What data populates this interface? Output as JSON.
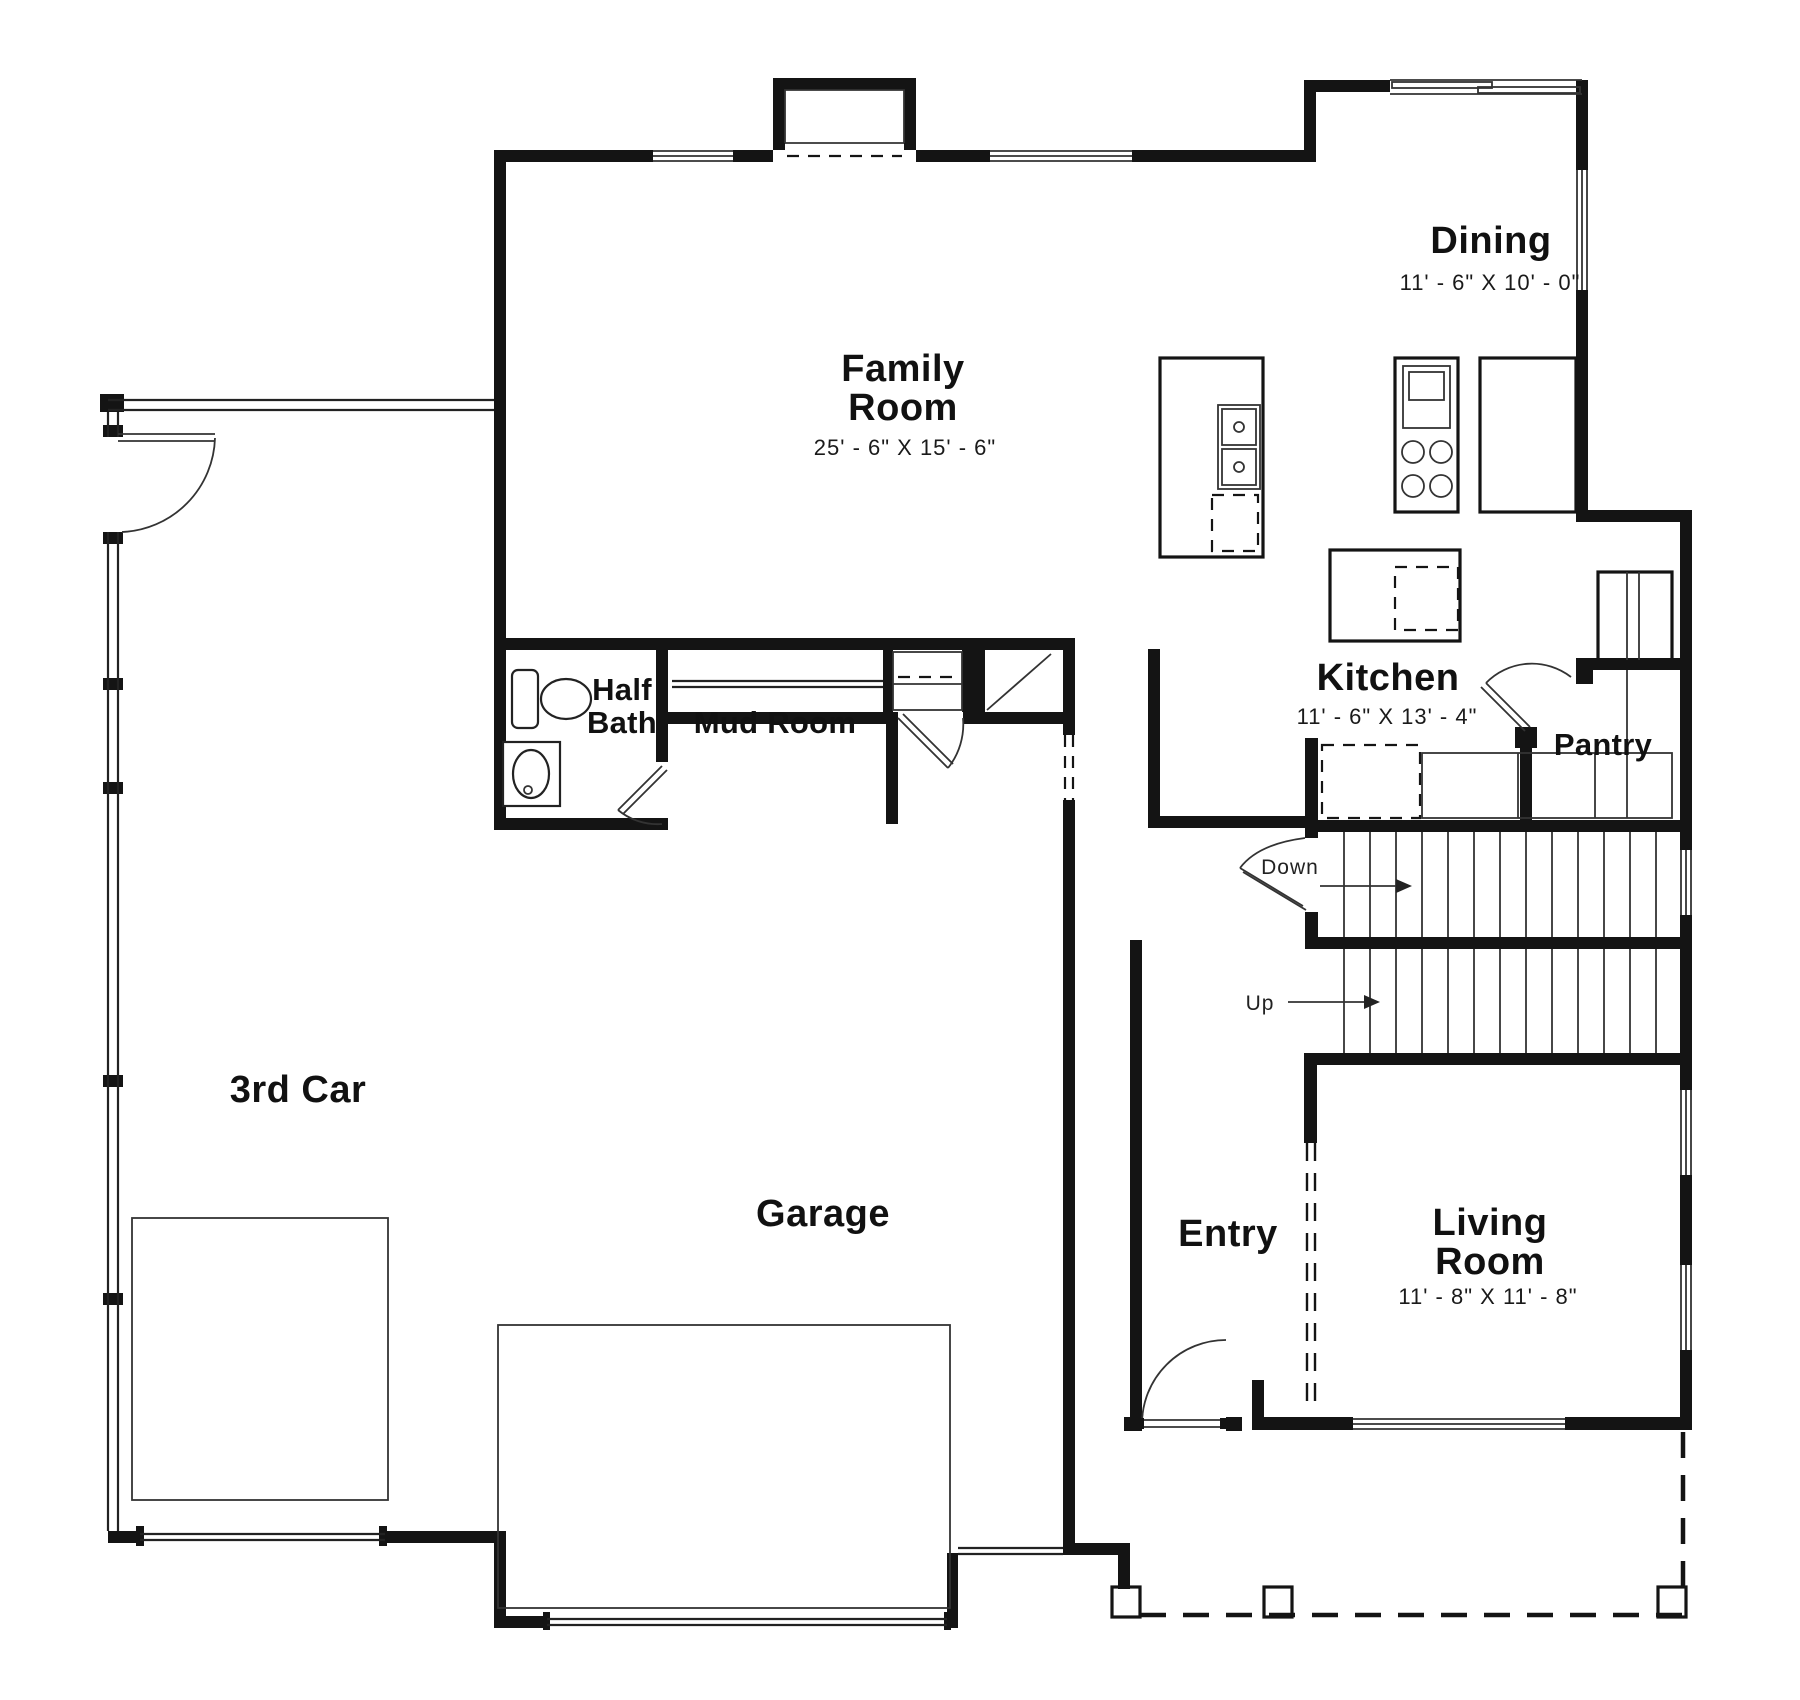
{
  "plan": {
    "type": "first-floor-plan",
    "background": "#ffffff",
    "wall_color": "#141414",
    "line_color": "#222222",
    "rooms": {
      "family": {
        "line1": "Family",
        "line2": "Room",
        "dims": "25' - 6\" X 15' - 6\""
      },
      "dining": {
        "label": "Dining",
        "dims": "11' - 6\" X 10' - 0\""
      },
      "kitchen": {
        "label": "Kitchen",
        "dims": "11' - 6\" X 13' - 4\""
      },
      "pantry": {
        "label": "Pantry"
      },
      "half_bath": {
        "line1": "Half",
        "line2": "Bath"
      },
      "mud_room": {
        "label": "Mud Room"
      },
      "third_car": {
        "label": "3rd Car"
      },
      "garage": {
        "label": "Garage"
      },
      "entry": {
        "label": "Entry"
      },
      "living": {
        "line1": "Living",
        "line2": "Room",
        "dims": "11' - 8\" X 11' - 8\""
      }
    },
    "stairs": {
      "down": "Down",
      "up": "Up"
    },
    "fixtures": [
      "toilet",
      "vanity-sink",
      "bench",
      "bifold-closet",
      "coat-closet",
      "kitchen-island",
      "double-sink",
      "dishwasher",
      "range-oven",
      "refrigerator",
      "pantry-shelf",
      "garage-door-panel",
      "porch-columns"
    ]
  }
}
